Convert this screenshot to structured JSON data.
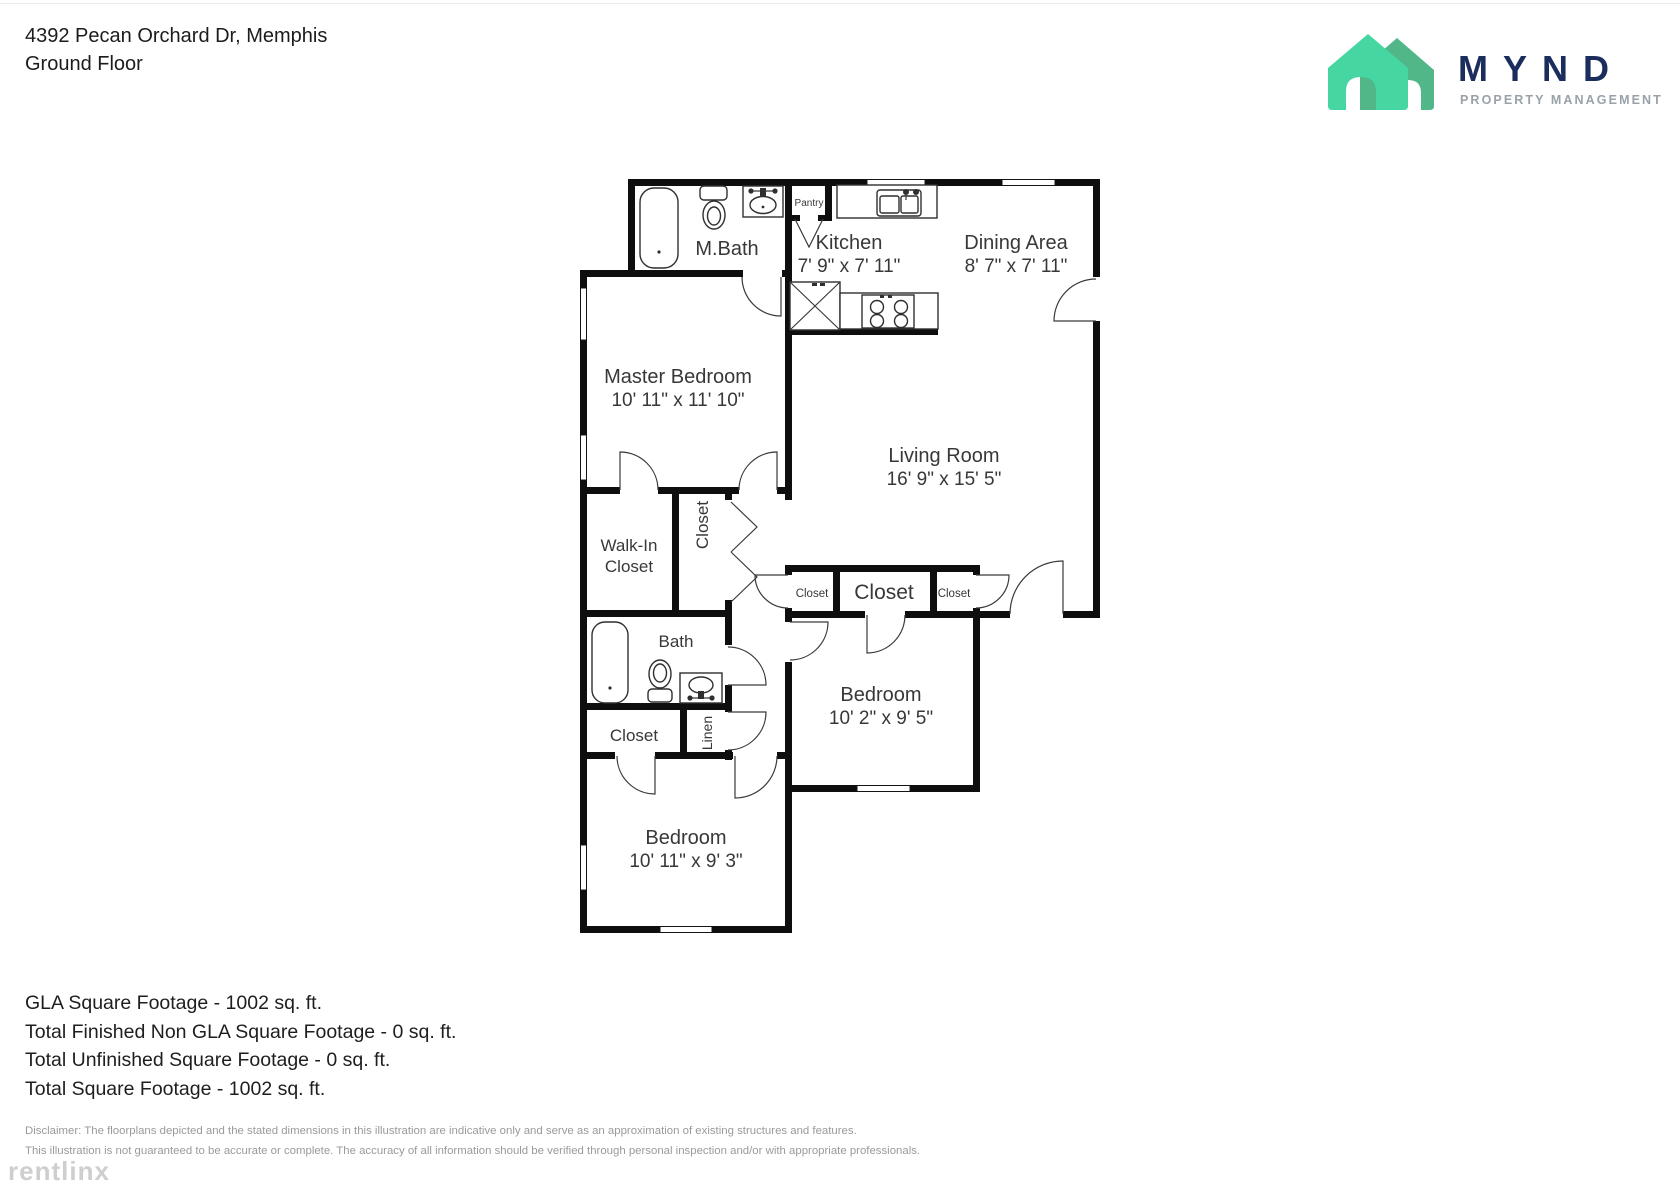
{
  "header": {
    "address": "4392 Pecan Orchard Dr, Memphis",
    "floor": "Ground Floor"
  },
  "logo": {
    "name": "MYND",
    "tagline": "PROPERTY MANAGEMENT",
    "colors": {
      "house_light_green": "#45D6A2",
      "house_dark_green": "#52B788",
      "wordmark_navy": "#1B2D5C",
      "tagline_gray": "#99A1A9"
    }
  },
  "plan": {
    "wall_color": "#0e0e0e",
    "label_color": "#383838",
    "rooms": {
      "m_bath": {
        "label": "M.Bath"
      },
      "pantry": {
        "label": "Pantry"
      },
      "kitchen": {
        "label": "Kitchen",
        "dims": "7' 9\" x 7' 11\""
      },
      "dining": {
        "label": "Dining Area",
        "dims": "8' 7\" x 7' 11\""
      },
      "master": {
        "label": "Master Bedroom",
        "dims": "10' 11\" x 11' 10\""
      },
      "living": {
        "label": "Living Room",
        "dims": "16' 9\" x 15' 5\""
      },
      "walk_in": {
        "line1": "Walk-In",
        "line2": "Closet"
      },
      "closet_hall": {
        "label": "Closet"
      },
      "closet_small_left": {
        "label": "Closet"
      },
      "closet_center": {
        "label": "Closet"
      },
      "closet_small_right": {
        "label": "Closet"
      },
      "bath": {
        "label": "Bath"
      },
      "bedroom_right": {
        "label": "Bedroom",
        "dims": "10' 2\" x 9' 5\""
      },
      "closet_bottom": {
        "label": "Closet"
      },
      "linen": {
        "label": "Linen"
      },
      "bedroom_bottom": {
        "label": "Bedroom",
        "dims": "10' 11\" x 9' 3\""
      }
    }
  },
  "footer": {
    "gla": "GLA Square Footage - 1002 sq. ft.",
    "non_gla": "Total Finished Non GLA Square Footage - 0 sq. ft.",
    "unfinished": "Total Unfinished Square Footage - 0 sq. ft.",
    "total": "Total Square Footage - 1002 sq. ft.",
    "disclaimer_line1": "Disclaimer: The floorplans depicted and the stated dimensions in this illustration are indicative only and serve as an approximation of existing structures and features.",
    "disclaimer_line2": "This illustration is not guaranteed to be accurate or complete. The accuracy of all information should be verified through personal inspection and/or with appropriate professionals."
  },
  "watermark": {
    "text": "rentlinx"
  }
}
